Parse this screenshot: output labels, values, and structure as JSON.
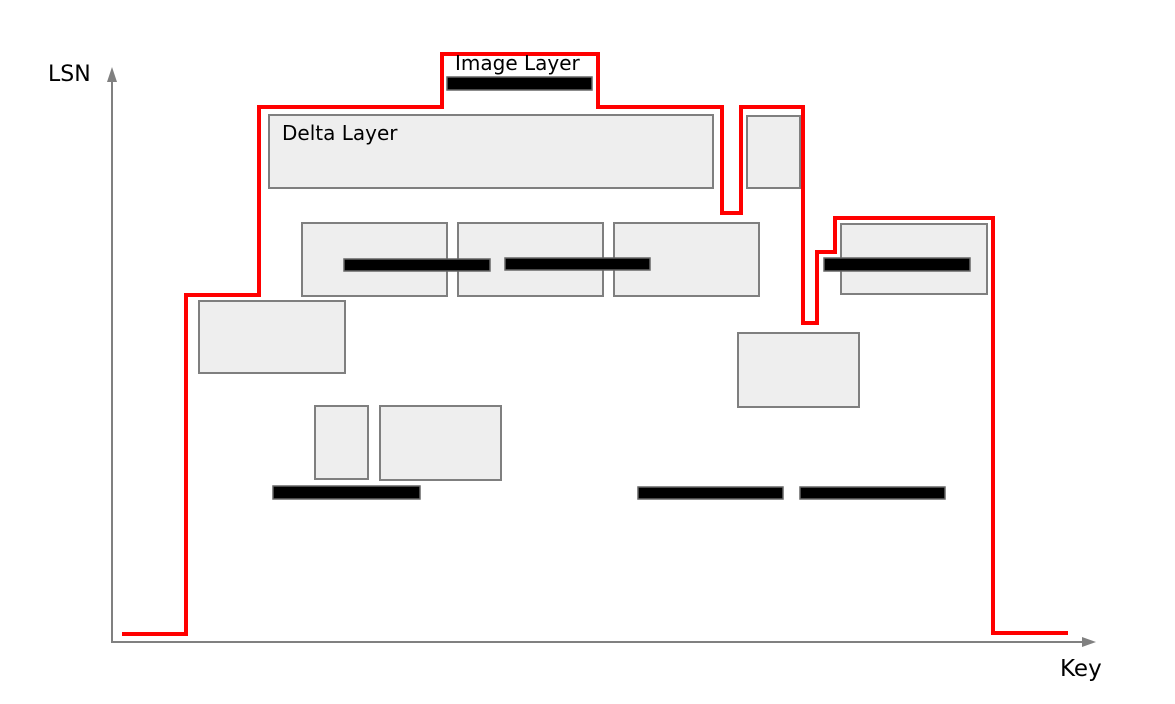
{
  "labels": {
    "y_axis": "LSN",
    "x_axis": "Key",
    "image_layer": "Image Layer",
    "delta_layer": "Delta Layer"
  },
  "colors": {
    "background": "#ffffff",
    "boundary": "#ff0000",
    "delta_fill": "#eeeeee",
    "delta_border": "#7f7f7f",
    "image_fill": "#000000",
    "image_border": "#666666",
    "axis": "#808080",
    "text": "#000000"
  },
  "diagram": {
    "width": 1175,
    "height": 704,
    "boundary_points": "122,634 186,634 186,295 259,295 259,107 442,107 442,54 598,54 598,107 722,107 722,213 741,213 741,107 803,107 803,323 817,323 817,252 835,252 835,218 993,218 993,633 1068,633",
    "delta_layers": [
      {
        "id": "delta-large-top",
        "x": 269,
        "y": 115,
        "w": 444,
        "h": 73
      },
      {
        "id": "delta-small-top",
        "x": 747,
        "y": 116,
        "w": 53,
        "h": 72
      },
      {
        "id": "delta-mid-a",
        "x": 302,
        "y": 223,
        "w": 145,
        "h": 73
      },
      {
        "id": "delta-mid-b",
        "x": 458,
        "y": 223,
        "w": 145,
        "h": 73
      },
      {
        "id": "delta-mid-c",
        "x": 614,
        "y": 223,
        "w": 145,
        "h": 73
      },
      {
        "id": "delta-right",
        "x": 841,
        "y": 224,
        "w": 146,
        "h": 70
      },
      {
        "id": "delta-left",
        "x": 199,
        "y": 301,
        "w": 146,
        "h": 72
      },
      {
        "id": "delta-lower-right",
        "x": 738,
        "y": 333,
        "w": 121,
        "h": 74
      },
      {
        "id": "delta-small-1",
        "x": 315,
        "y": 406,
        "w": 53,
        "h": 73
      },
      {
        "id": "delta-small-2",
        "x": 380,
        "y": 406,
        "w": 121,
        "h": 74
      }
    ],
    "image_layers": [
      {
        "id": "image-top",
        "x": 447,
        "y": 77,
        "w": 145,
        "h": 13
      },
      {
        "id": "image-mid-1",
        "x": 344,
        "y": 259,
        "w": 146,
        "h": 12
      },
      {
        "id": "image-mid-2",
        "x": 505,
        "y": 258,
        "w": 145,
        "h": 12
      },
      {
        "id": "image-right",
        "x": 824,
        "y": 258,
        "w": 146,
        "h": 13
      },
      {
        "id": "image-bottom-1",
        "x": 273,
        "y": 486,
        "w": 147,
        "h": 13
      },
      {
        "id": "image-bottom-2",
        "x": 638,
        "y": 487,
        "w": 145,
        "h": 12
      },
      {
        "id": "image-bottom-3",
        "x": 800,
        "y": 487,
        "w": 145,
        "h": 12
      }
    ],
    "axes": {
      "y": {
        "x": 112,
        "y_bottom": 643,
        "y_top": 80
      },
      "x": {
        "y": 642,
        "x_left": 112,
        "x_right": 1082
      }
    }
  }
}
